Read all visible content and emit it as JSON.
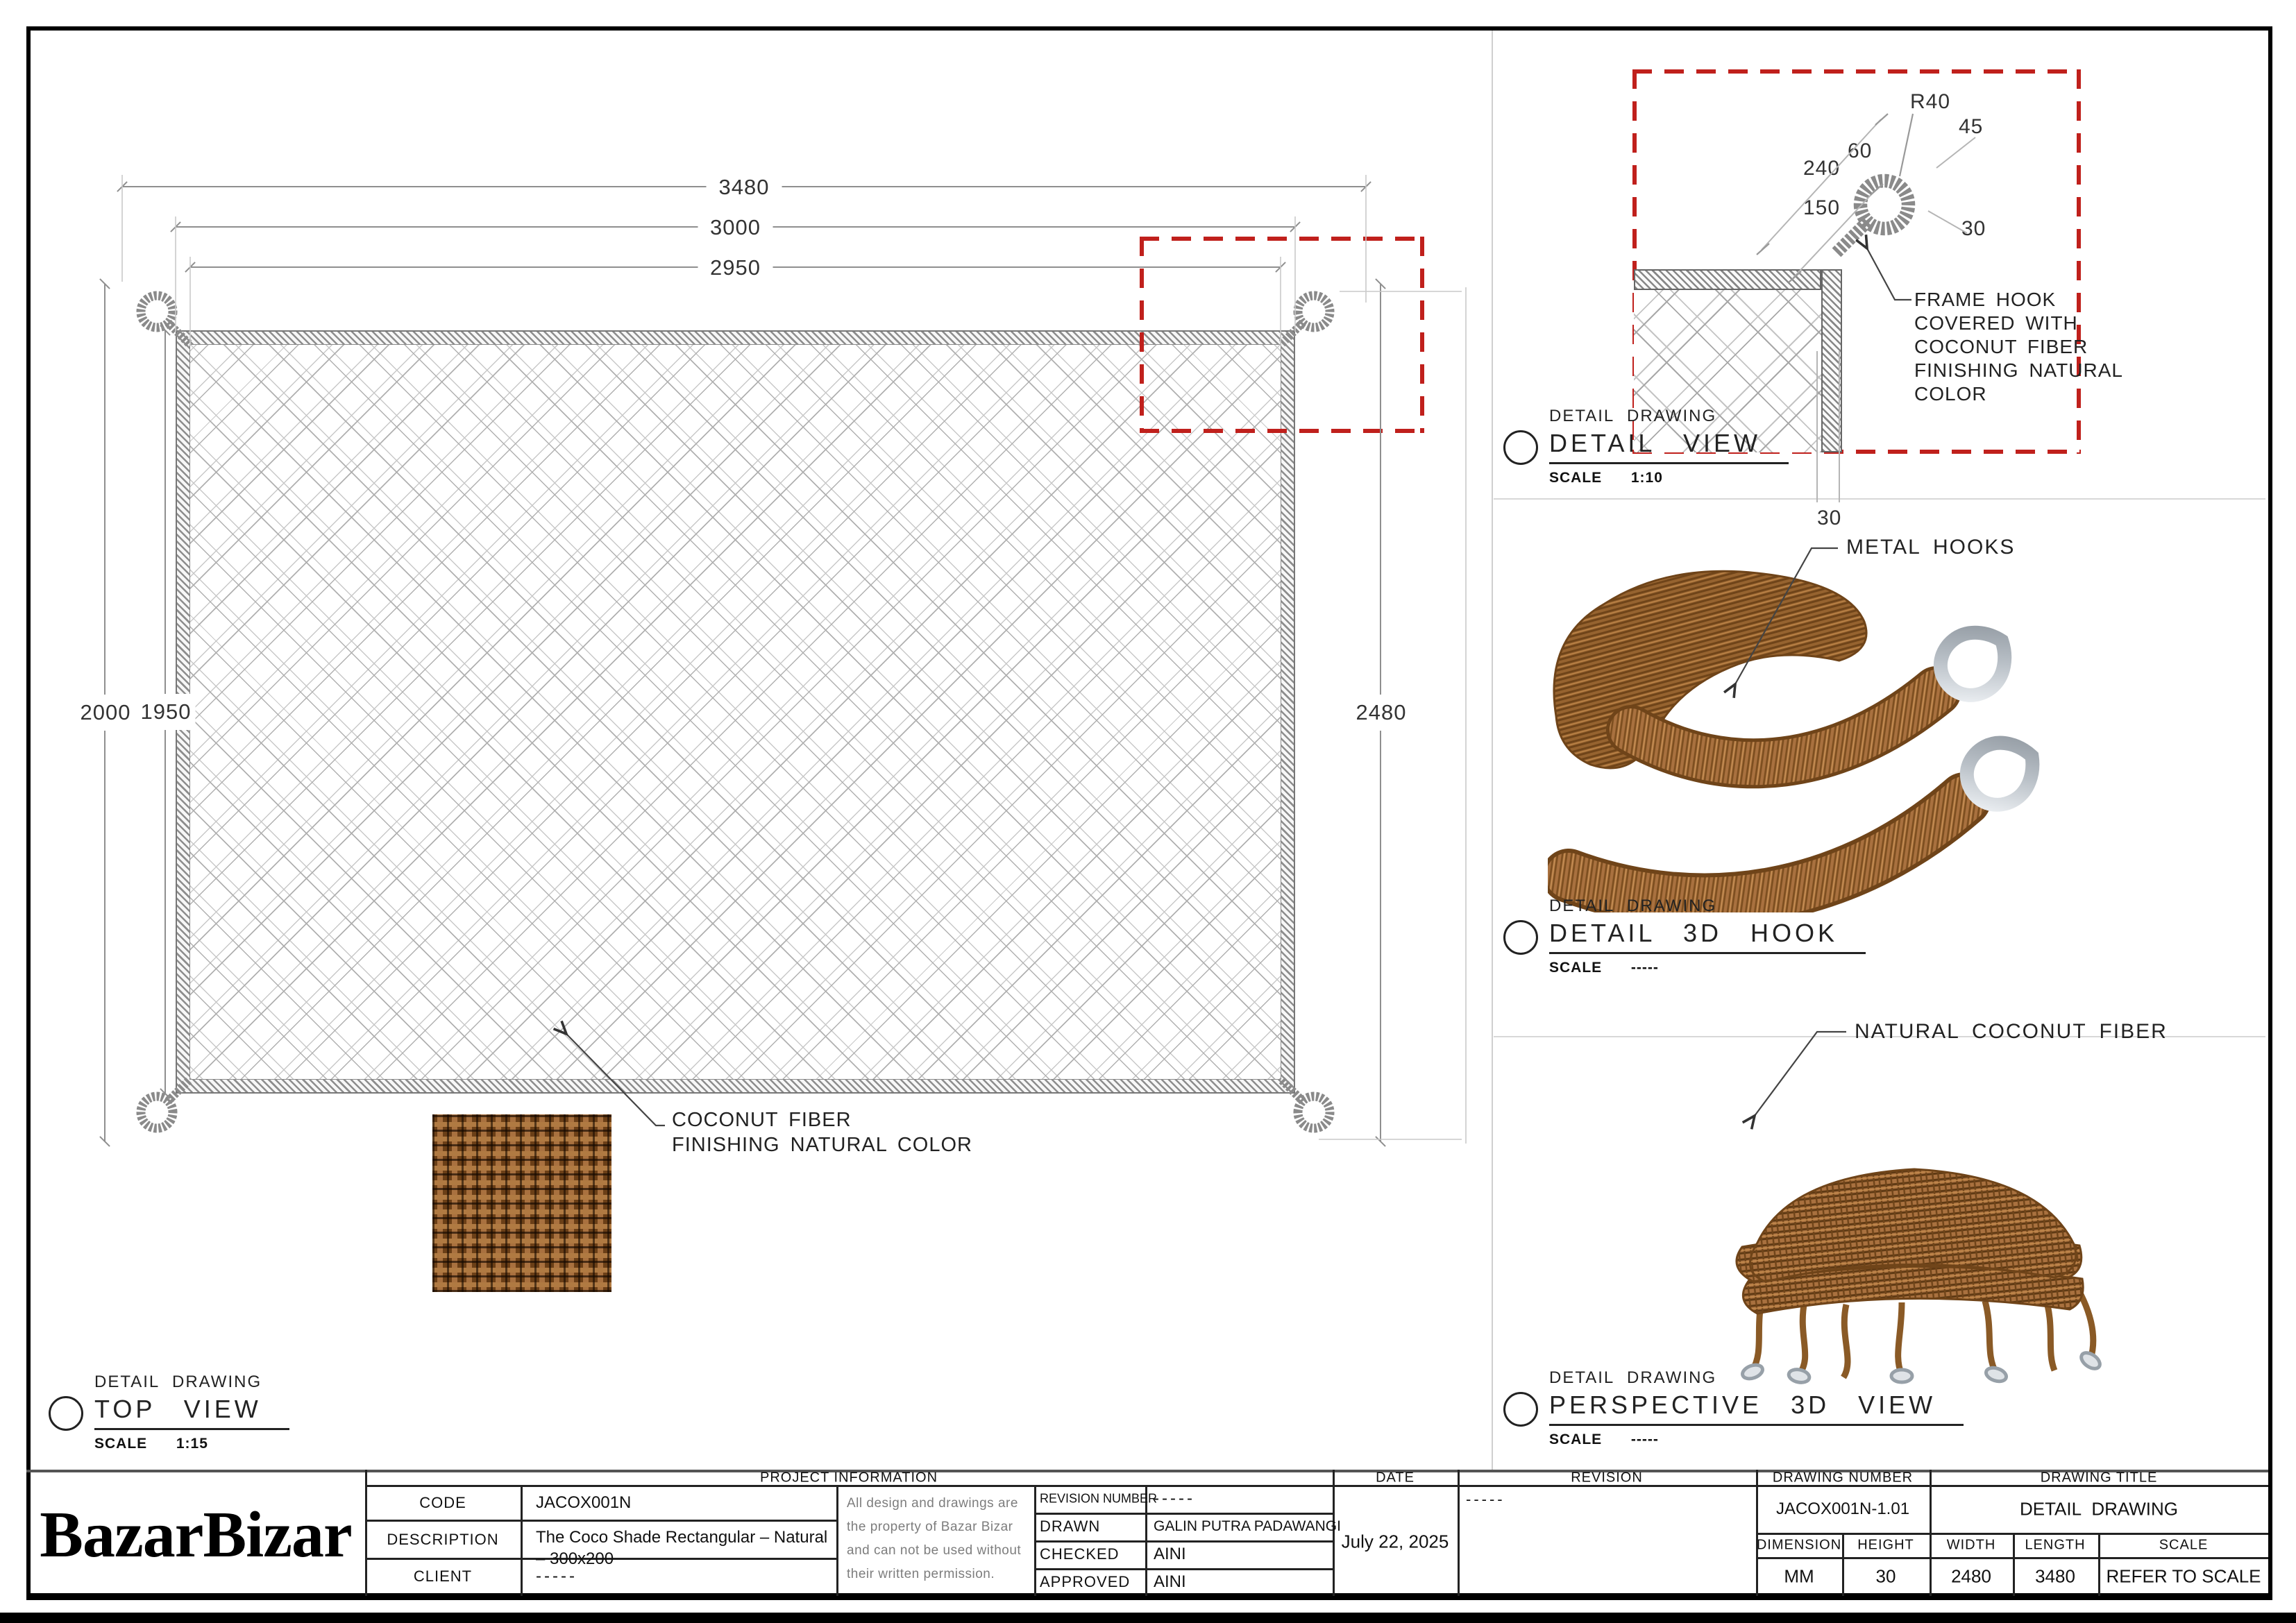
{
  "colors": {
    "accent_red": "#c0201c",
    "coir_brown": "#a9713f",
    "metal_gray": "#c9ced4"
  },
  "brand": {
    "logo_text": "BazarBizar"
  },
  "top_view": {
    "dim_top_outer": "3480",
    "dim_top_mid": "3000",
    "dim_top_inner": "2950",
    "dim_left_outer": "2000",
    "dim_left_inner": "1950",
    "dim_right": "2480",
    "note_line1": "COCONUT FIBER",
    "note_line2": "FINISHING NATURAL COLOR",
    "label": {
      "kicker": "DETAIL DRAWING",
      "title": "TOP VIEW",
      "scale_word": "SCALE",
      "scale_value": "1:15"
    }
  },
  "detail_view": {
    "dim_r40": "R40",
    "dim_45": "45",
    "dim_60": "60",
    "dim_240": "240",
    "dim_150": "150",
    "dim_30_side": "30",
    "dim_30_bottom": "30",
    "note_line1": "FRAME HOOK",
    "note_line2": "COVERED WITH",
    "note_line3": "COCONUT FIBER",
    "note_line4": "FINISHING NATURAL",
    "note_line5": "COLOR",
    "label": {
      "kicker": "DETAIL DRAWING",
      "title": "DETAIL VIEW",
      "scale_word": "SCALE",
      "scale_value": "1:10"
    }
  },
  "hook_view": {
    "callout": "METAL HOOKS",
    "label": {
      "kicker": "DETAIL DRAWING",
      "title": "DETAIL 3D HOOK",
      "scale_word": "SCALE",
      "scale_value": "-----"
    }
  },
  "perspective_view": {
    "callout": "NATURAL COCONUT FIBER",
    "label": {
      "kicker": "DETAIL DRAWING",
      "title": "PERSPECTIVE 3D VIEW",
      "scale_word": "SCALE",
      "scale_value": "-----"
    }
  },
  "title_block": {
    "project_information_header": "PROJECT INFORMATION",
    "code_label": "CODE",
    "code_value": "JACOX001N",
    "description_label": "DESCRIPTION",
    "description_value": "The Coco Shade Rectangular – Natural – 300x200",
    "client_label": "CLIENT",
    "client_value": "-----",
    "disclaimer": "All design and drawings are the property of Bazar Bizar and can not be used without their written permission.",
    "revision_number_label": "REVISION NUMBER",
    "revision_number_value": "-----",
    "drawn_label": "DRAWN",
    "drawn_value": "GALIN PUTRA PADAWANGI",
    "checked_label": "CHECKED",
    "checked_value": "AINI",
    "approved_label": "APPROVED",
    "approved_value": "AINI",
    "date_header": "DATE",
    "date_value": "July 22, 2025",
    "revision_header": "REVISION",
    "revision_value": "-----",
    "drawing_number_header": "DRAWING NUMBER",
    "drawing_number_value": "JACOX001N-1.01",
    "drawing_title_header": "DRAWING TITLE",
    "drawing_title_value": "DETAIL DRAWING",
    "spec": {
      "headers": [
        "DIMENSION",
        "HEIGHT",
        "WIDTH",
        "LENGTH",
        "SCALE"
      ],
      "values": [
        "MM",
        "30",
        "2480",
        "3480",
        "REFER TO SCALE"
      ]
    }
  }
}
